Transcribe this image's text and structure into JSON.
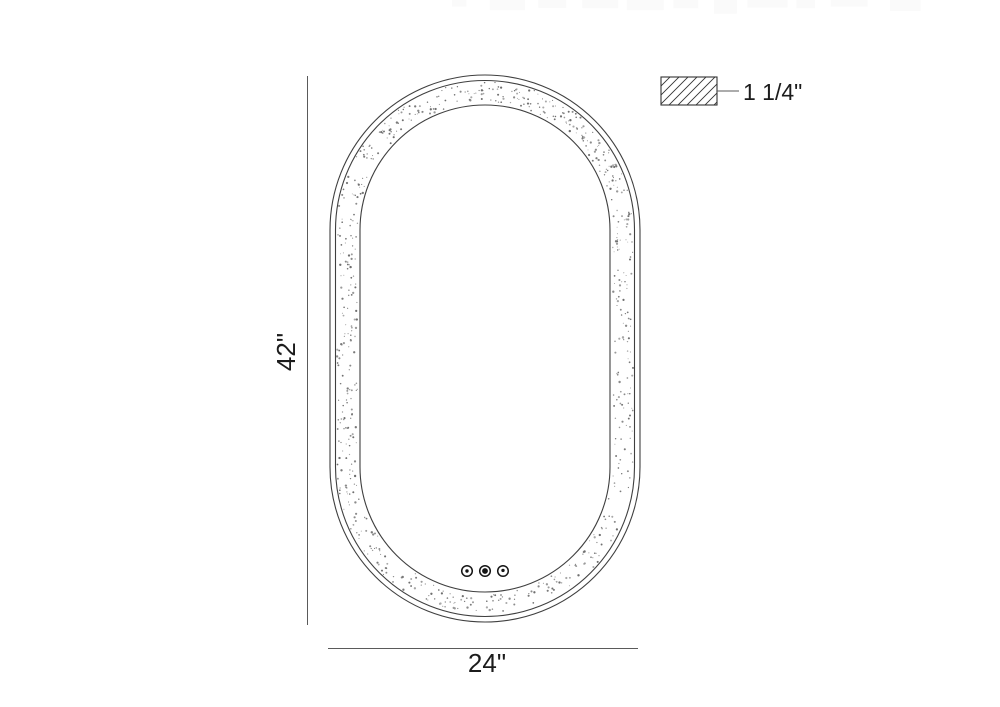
{
  "drawing": {
    "title": "mirror-dimension-drawing",
    "height_dimension": {
      "label": "42\""
    },
    "width_dimension": {
      "label": "24\""
    },
    "thickness_callout": {
      "label": "1 1/4\""
    },
    "touch_controls": {
      "count": 3
    },
    "colors": {
      "outline": "#3f3f3f",
      "dimension_line": "#5a5a5a",
      "text": "#1c1c1c",
      "stipple": [
        "#6f6f6f",
        "#7a7a7a",
        "#8b8b8b",
        "#9a9a9a",
        "#a8a8a8"
      ],
      "watermark": "#fafafa"
    }
  }
}
